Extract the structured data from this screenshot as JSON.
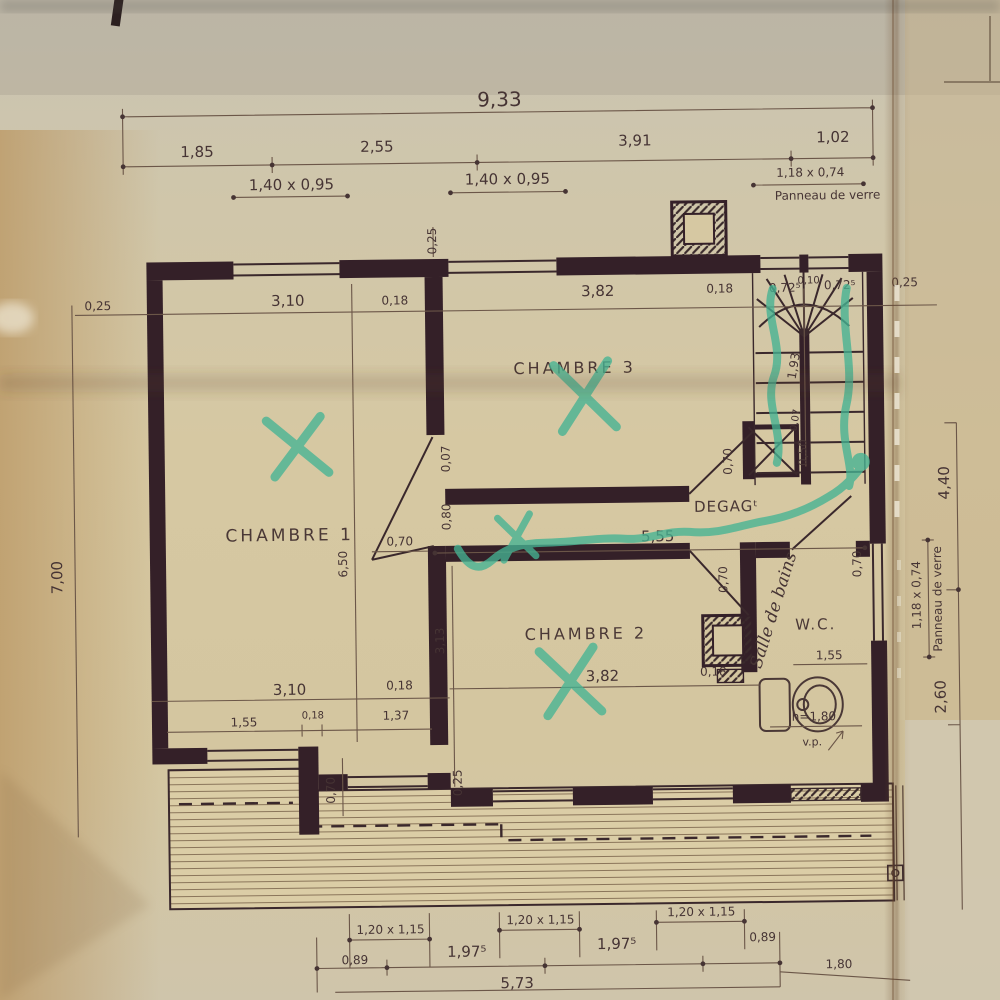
{
  "drawing": {
    "rooms": {
      "chambre1": "CHAMBRE 1",
      "chambre3": "CHAMBRE 3",
      "chambre2": "CHAMBRE 2",
      "degagement": "DEGAGᵗ",
      "wc": "W.C.",
      "salle_de_bains": "Salle de bains"
    },
    "top_dims": {
      "total": "9,33",
      "segments": [
        "1,85",
        "2,55",
        "3,91",
        "1,02"
      ],
      "window1": "1,40 x 0,95",
      "window2": "1,40 x 0,95",
      "glass_size": "1,18 x 0,74",
      "glass_name": "Panneau de verre"
    },
    "wall_top_row": [
      "0,25",
      "3,10",
      "0,18",
      "3,82",
      "0,18",
      "0,72⁵",
      "0,10",
      "0,72⁵",
      "0,25"
    ],
    "interior_wall_top": "0,25",
    "left_dims": {
      "height": "7,00"
    },
    "right_dims": {
      "upper": "4,40",
      "lower": "2,60",
      "glass_size": "1,18 x 0,74",
      "glass_name": "Panneau de verre"
    },
    "stairs": {
      "depth": "1,93",
      "spine": "0,07",
      "duct": "0,50"
    },
    "corridor": {
      "wall": "0,07",
      "door": "0,80",
      "length": "5,55"
    },
    "room_dims": {
      "chambre1_depth": "6,50",
      "chambre2_depth": "3,13"
    },
    "doors": {
      "chambre1": "0,70",
      "chambre3": "0,70",
      "chambre2": "0,70",
      "bathroom": "0,70",
      "step": "0,70"
    },
    "mid_row": [
      "3,10",
      "0,18",
      "3,82",
      "0,18"
    ],
    "wc_width": "1,55",
    "sub_row": [
      "1,55",
      "0,18",
      "1,37"
    ],
    "bottom_left_wall": "0,25",
    "toilet": {
      "height": "h=1,80",
      "vp": "v.p."
    },
    "bottom_dims": {
      "windows": [
        "1,20 x 1,15",
        "1,20 x 1,15",
        "1,20 x 1,15"
      ],
      "segments": [
        "0,89",
        "1,97⁵",
        "1,97⁵",
        "0,89",
        "1,80"
      ],
      "total": "5,73"
    }
  },
  "colors": {
    "ink": "#463434",
    "wall": "#342028",
    "marker": "#45b393",
    "paper": "#d4c6a0"
  }
}
